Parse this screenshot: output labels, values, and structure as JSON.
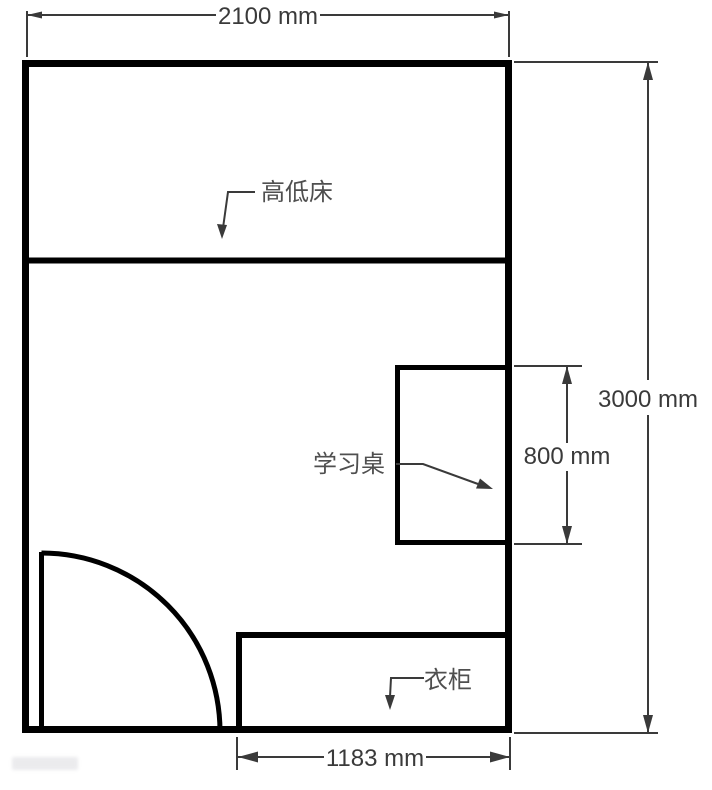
{
  "drawing": {
    "kind": "bedroom floor plan",
    "dimensions": {
      "room_width": "2100 mm",
      "room_height": "3000 mm",
      "desk_depth": "800 mm",
      "wardrobe_width": "1183 mm"
    },
    "furniture_labels": {
      "bed": "高低床",
      "desk": "学习桌",
      "wardrobe": "衣柜"
    },
    "colors": {
      "wall_line": "#000000",
      "dimension_line": "#3a3a3a",
      "label_text": "#4f4f4f",
      "background": "#ffffff"
    }
  }
}
